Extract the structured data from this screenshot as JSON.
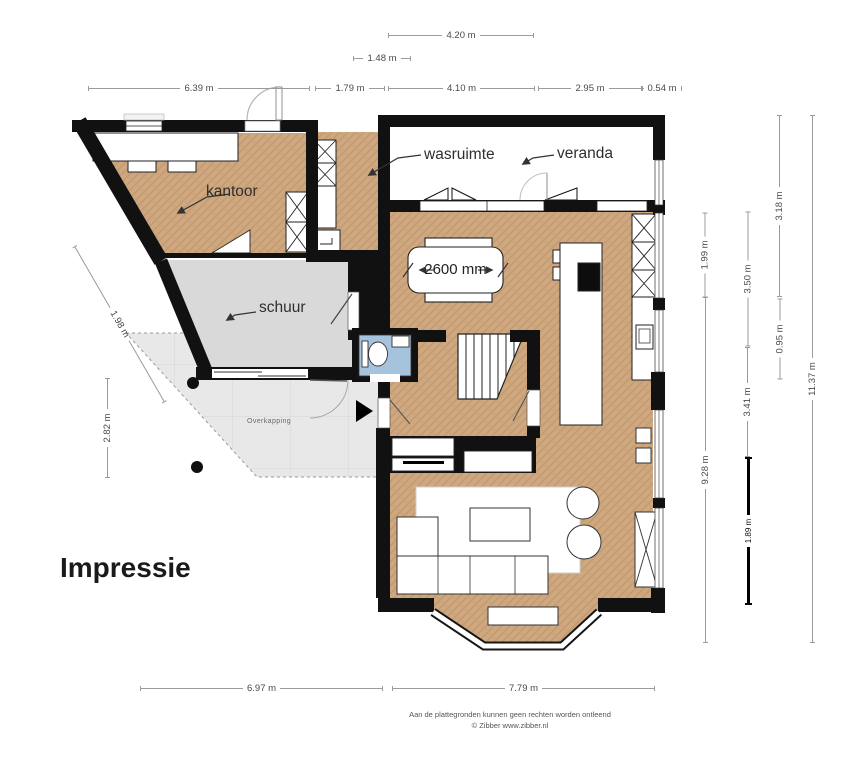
{
  "title": "Impressie",
  "room_labels": {
    "kantoor": "kantoor",
    "wasruimte": "wasruimte",
    "veranda": "veranda",
    "schuur": "schuur",
    "overkapping": "Overkapping"
  },
  "annotations": {
    "table_width": "2600 mm"
  },
  "dimensions": {
    "top_a": "4.20 m",
    "top_b": "1.48 m",
    "row": [
      "6.39 m",
      "1.79 m",
      "4.10 m",
      "2.95 m",
      "0.54 m"
    ],
    "left_diag": "1.98 m",
    "left_v": "2.82 m",
    "right": {
      "r1": "1.99 m",
      "r2": "9.28 m",
      "r3": "3.50 m",
      "r4": "3.41 m",
      "r5": "1.89 m",
      "r6": "3.18 m",
      "r7": "0.95 m",
      "r8": "11.37 m"
    },
    "bottom": [
      "6.97 m",
      "7.79 m"
    ]
  },
  "footer": {
    "line1": "Aan de plattegronden kunnen geen rechten worden ontleend",
    "line2": "© Zibber www.zibber.nl"
  },
  "colors": {
    "wall": "#111111",
    "wood_floor": "#cfa87f",
    "shed_floor": "#d9d9d9",
    "canopy_floor": "#e8e8e8",
    "toilet_floor": "#a6c3de",
    "dimension_line": "#9b9b9b",
    "label_text": "#2e2e2e"
  }
}
